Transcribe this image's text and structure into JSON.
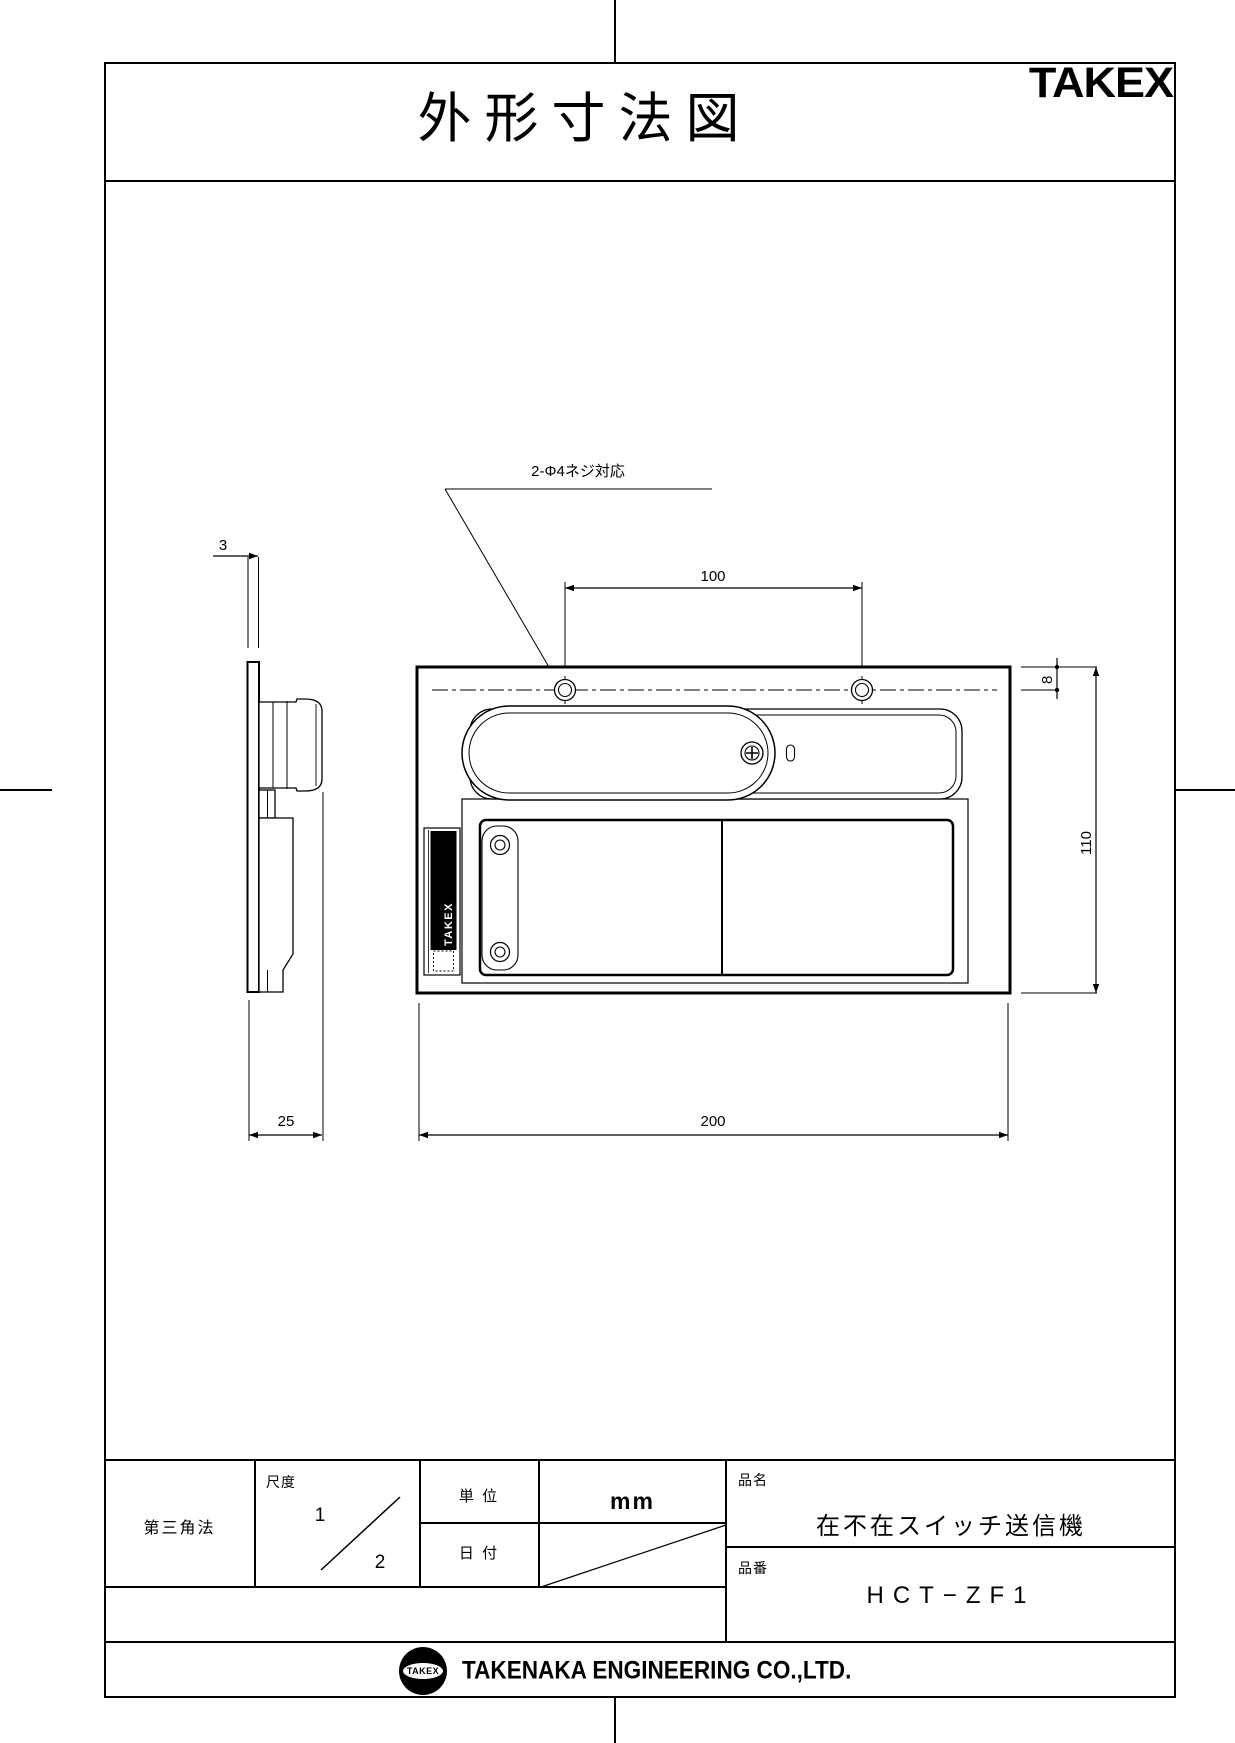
{
  "page": {
    "title": "外形寸法図",
    "brand_logo": "TAKEX"
  },
  "drawing": {
    "leader_label": "2-Φ4ネジ対応",
    "strip_label": "TAKEX",
    "dimensions": {
      "plate_thickness": "3",
      "hole_spacing": "100",
      "hole_offset_from_top": "8",
      "body_height": "110",
      "side_depth": "25",
      "body_width": "200"
    }
  },
  "title_block": {
    "projection": "第三角法",
    "scale_label": "尺度",
    "scale_numerator": "1",
    "scale_denominator": "2",
    "unit_label": "単 位",
    "unit_value": "mm",
    "date_label": "日 付",
    "name_label": "品名",
    "name_value": "在不在スイッチ送信機",
    "number_label": "品番",
    "number_value": "HCT−ZF1"
  },
  "footer": {
    "badge": "TAKEX",
    "company": "TAKENAKA ENGINEERING CO.,LTD."
  }
}
